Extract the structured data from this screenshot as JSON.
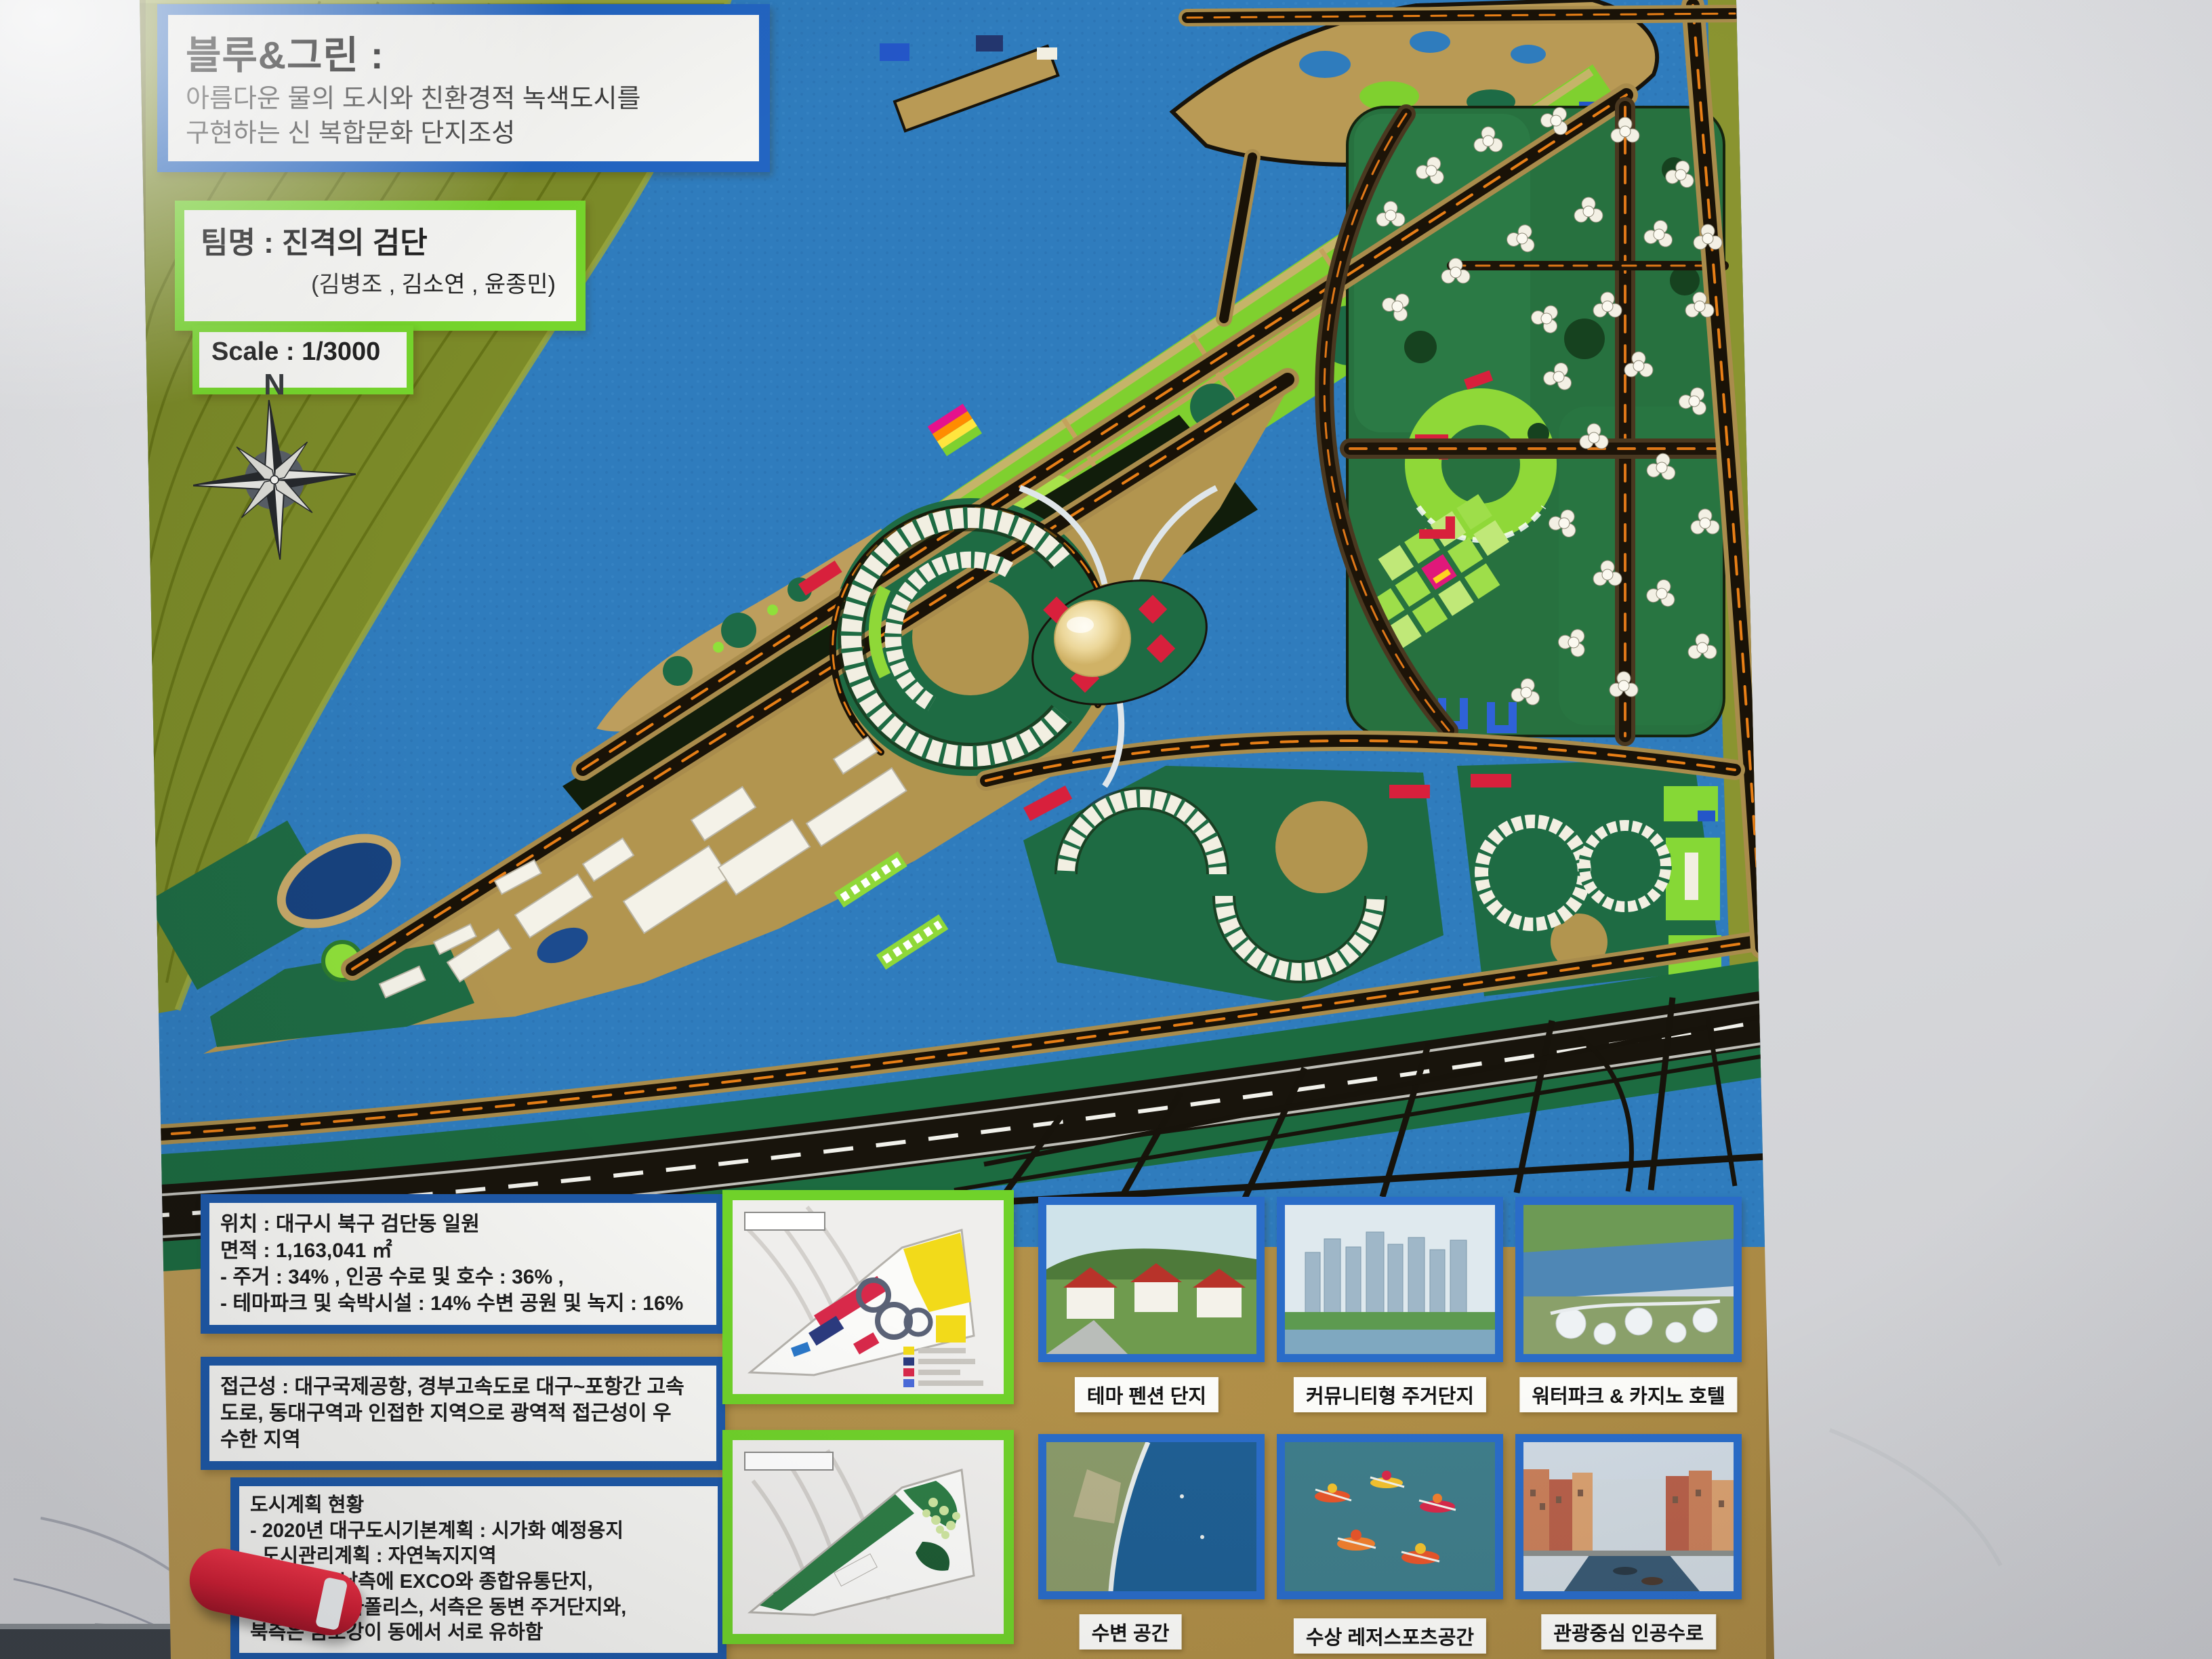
{
  "board": {
    "title_box": {
      "title": "블루&그린 :",
      "line1": "아름다운 물의 도시와 친환경적 녹색도시를",
      "line2": "구현하는 신 복합문화 단지조성"
    },
    "team_box": {
      "team": "팀명 : 진격의 검단",
      "members": "(김병조 , 김소연 , 윤종민)"
    },
    "scale_box": {
      "label": "Scale : 1/3000"
    },
    "compass": {
      "north_label": "N"
    }
  },
  "info_panel": {
    "location_box": {
      "lines": [
        "위치 : 대구시 북구 검단동 일원",
        "면적 : 1,163,041 ㎡",
        "- 주거 : 34% , 인공 수로 및 호수 : 36% ,",
        "- 테마파크 및 숙박시설 : 14% 수변 공원 및 녹지 : 16%"
      ]
    },
    "access_box": {
      "lines": [
        "접근성 : 대구국제공항, 경부고속도로 대구~포항간 고속",
        "도로, 동대구역과 인접한 지역으로 광역적 접근성이 우",
        "수한 지역"
      ]
    },
    "plan_box": {
      "lines": [
        "도시계획 현황",
        "- 2020년 대구도시기본계획 : 시가화 예정용지",
        "- 도시관리계획 : 자연녹지지역",
        "주변현황 : 남측에 EXCO와 종합유통단지,",
        "동측에 이시아폴리스, 서측은 동변 주거단지와,",
        "북측은 금호강이 동에서 서로 유하함"
      ]
    }
  },
  "gallery": {
    "items": [
      {
        "caption": "테마 펜션 단지"
      },
      {
        "caption": "커뮤니티형 주거단지"
      },
      {
        "caption": "워터파크 & 카지노 호텔"
      },
      {
        "caption": "수변 공간"
      },
      {
        "caption": "수상 레저스포츠공간"
      },
      {
        "caption": "관광중심 인공수로"
      }
    ]
  },
  "colors": {
    "water": "#2f7cbd",
    "board_tan": "#b6954e",
    "hill_olive": "#7c8b28",
    "park_green": "#7fd02f",
    "parcel_green": "#1e6b43",
    "road_dark": "#1d1408",
    "road_orange": "#e07818",
    "accent_red": "#d8203c",
    "border_blue": "#2365c2",
    "border_green": "#76d62c"
  }
}
